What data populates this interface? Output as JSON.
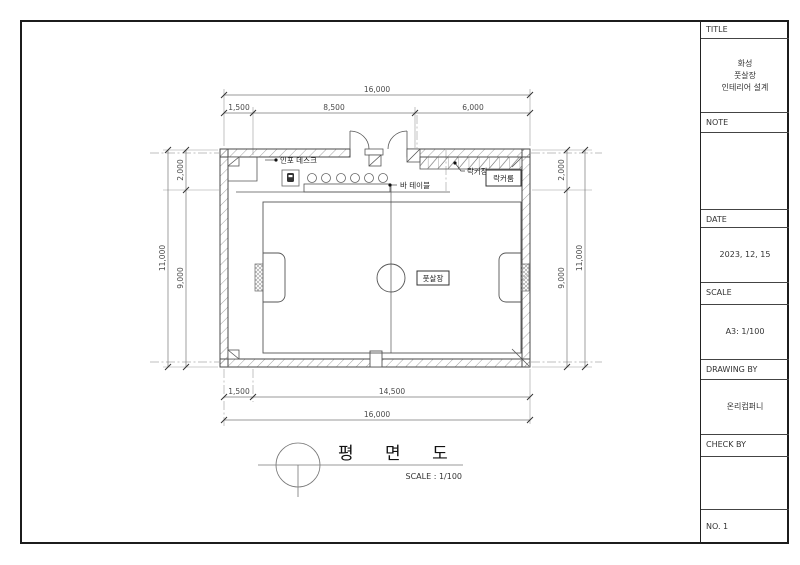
{
  "title_block": {
    "title_label": "TITLE",
    "title_value_lines": [
      "화성",
      "풋살장",
      "인테리어 설계"
    ],
    "note_label": "NOTE",
    "date_label": "DATE",
    "date_value": "2023, 12, 15",
    "scale_label": "SCALE",
    "scale_value": "A3: 1/100",
    "drawing_by_label": "DRAWING BY",
    "drawing_by_value": "온리컴퍼니",
    "check_by_label": "CHECK BY",
    "no_label": "NO. 1"
  },
  "labels": {
    "info_desk": "인포 데스크",
    "bar_table": "바 테이블",
    "locker_cabinet": "락커장",
    "locker_room": "락커룸",
    "futsal_field": "풋살장",
    "plan_title": "평 면 도",
    "plan_scale": "SCALE : 1/100"
  },
  "dims": {
    "top_total": "16,000",
    "top_segments": [
      "1,500",
      "8,500",
      "6,000"
    ],
    "left_outer": "11,000",
    "left_segments": [
      "2,000",
      "9,000"
    ],
    "right_segments": [
      "2,000",
      "9,000"
    ],
    "right_outer": "11,000",
    "bottom_segments": [
      "1,500",
      "14,500"
    ],
    "bottom_total": "16,000"
  }
}
